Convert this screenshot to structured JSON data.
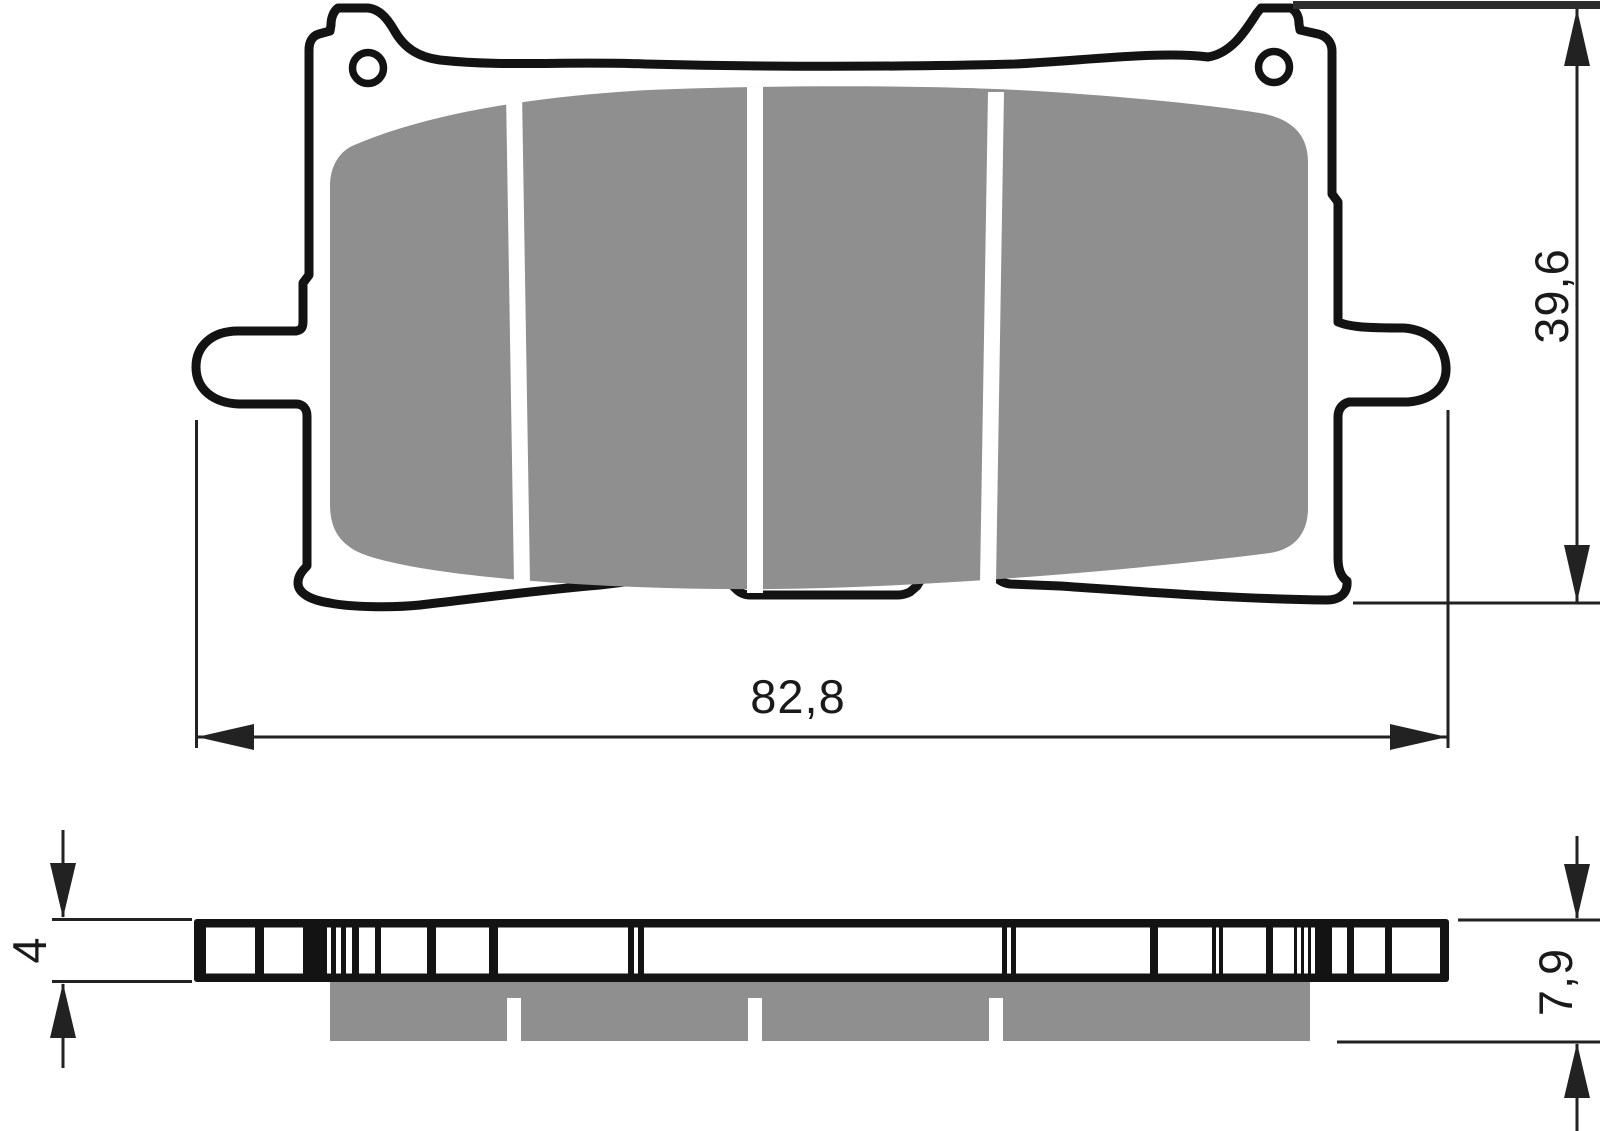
{
  "colors": {
    "background": "#ffffff",
    "outline": "#131313",
    "plate": "#ffffff",
    "friction": "#8f8f8f",
    "dimension": "#222222",
    "extbar": "#2e2e2e",
    "text": "#1a1a1a"
  },
  "dimension_labels": {
    "overall_width_mm": "82,8",
    "overall_height_mm": "39,6",
    "backplate_thickness_mm": "4",
    "total_thickness_mm": "7,9"
  },
  "front_view": {
    "mount_hole_count": 2,
    "friction_segment_count": 4,
    "divider_positions_x": [
      514,
      755,
      996
    ]
  },
  "side_view": {
    "plate_span_x": [
      194,
      1449
    ],
    "plate_span_y": [
      919,
      982
    ],
    "white_segments_x": [
      [
        206,
        255
      ],
      [
        264,
        303
      ],
      [
        327,
        331
      ],
      [
        336,
        341
      ],
      [
        346,
        352
      ],
      [
        359,
        375
      ],
      [
        381,
        427
      ],
      [
        436,
        489
      ],
      [
        498,
        628
      ],
      [
        634,
        638
      ],
      [
        644,
        1002
      ],
      [
        1007,
        1011
      ],
      [
        1016,
        1150
      ],
      [
        1158,
        1212
      ],
      [
        1216,
        1219
      ],
      [
        1223,
        1266
      ],
      [
        1273,
        1294
      ],
      [
        1297,
        1301
      ],
      [
        1304,
        1308
      ],
      [
        1311,
        1315
      ],
      [
        1332,
        1347
      ],
      [
        1354,
        1385
      ],
      [
        1392,
        1440
      ]
    ],
    "friction_span_x": [
      330,
      1310
    ],
    "friction_span_y": [
      982,
      1041
    ],
    "groove_spans_x": [
      [
        507,
        521
      ],
      [
        748,
        762
      ],
      [
        989,
        1003
      ]
    ]
  }
}
